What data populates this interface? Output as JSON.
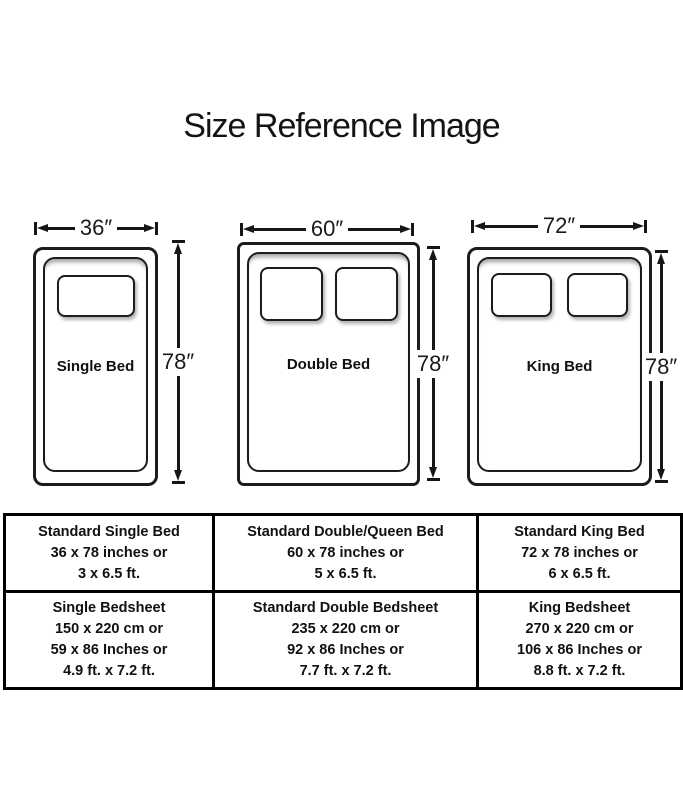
{
  "title": "Size Reference Image",
  "colors": {
    "line": "#1c1c1c",
    "background": "#ffffff",
    "table_border": "#000000"
  },
  "beds": [
    {
      "name": "Single Bed",
      "width_label": "36″",
      "height_label": "78″"
    },
    {
      "name": "Double Bed",
      "width_label": "60″",
      "height_label": "78″"
    },
    {
      "name": "King Bed",
      "width_label": "72″",
      "height_label": "78″"
    }
  ],
  "table": {
    "rows": [
      {
        "cells": [
          {
            "lines": [
              "Standard Single Bed",
              "36 x 78 inches or",
              "3 x 6.5 ft."
            ]
          },
          {
            "lines": [
              "Standard Double/Queen Bed",
              "60 x 78 inches or",
              "5 x 6.5 ft."
            ]
          },
          {
            "lines": [
              "Standard King Bed",
              "72 x 78 inches or",
              "6 x 6.5 ft."
            ]
          }
        ]
      },
      {
        "cells": [
          {
            "lines": [
              "Single Bedsheet",
              "150 x 220 cm or",
              "59 x 86 Inches or",
              "4.9 ft. x 7.2 ft."
            ]
          },
          {
            "lines": [
              "Standard Double Bedsheet",
              "235 x 220 cm or",
              "92 x 86 Inches or",
              "7.7 ft. x 7.2 ft."
            ]
          },
          {
            "lines": [
              "King Bedsheet",
              "270 x 220 cm or",
              "106 x 86 Inches or",
              "8.8 ft. x 7.2 ft."
            ]
          }
        ]
      }
    ]
  }
}
